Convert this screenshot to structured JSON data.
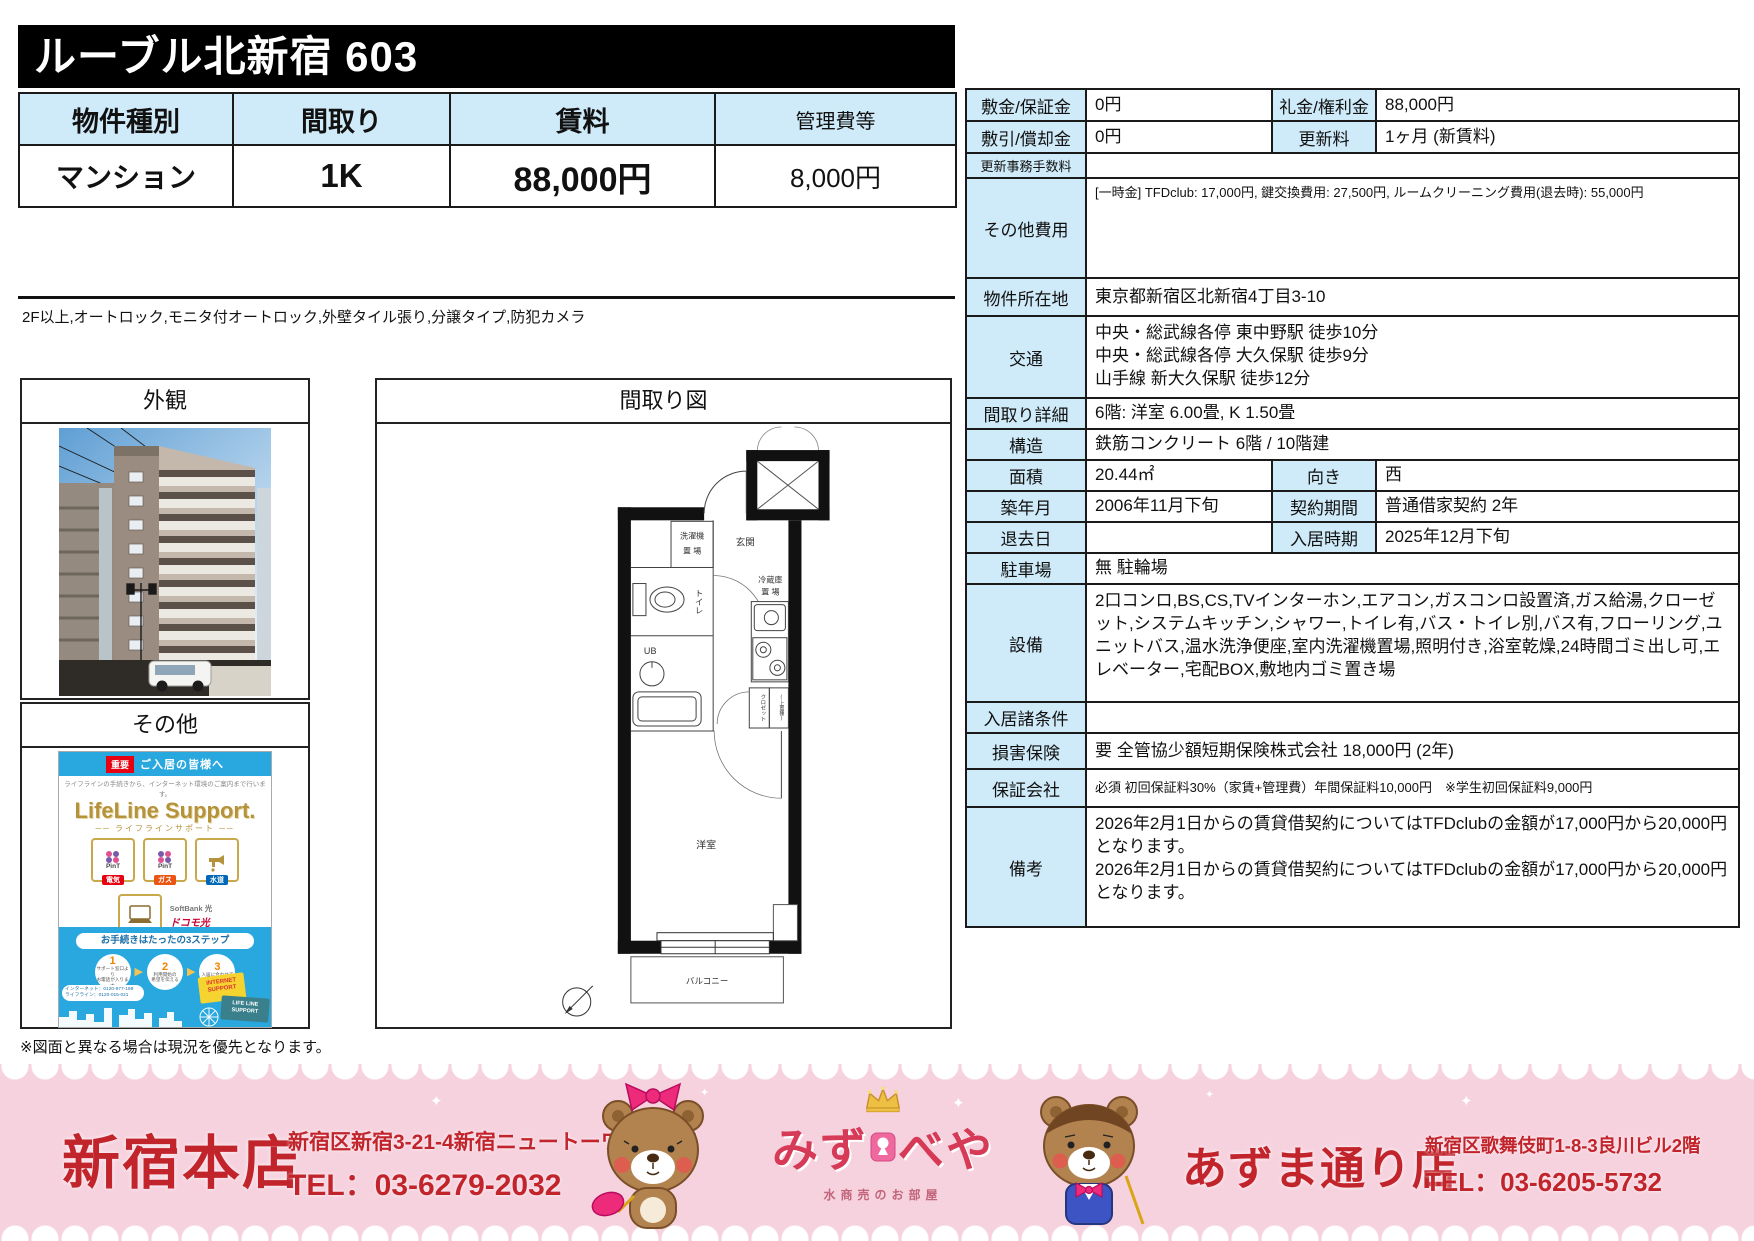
{
  "title": "ルーブル北新宿 603",
  "summary": {
    "headers": [
      "物件種別",
      "間取り",
      "賃料",
      "管理費等"
    ],
    "values": [
      "マンション",
      "1K",
      "88,000円",
      "8,000円"
    ]
  },
  "features": "2F以上,オートロック,モニタ付オートロック,外壁タイル張り,分譲タイプ,防犯カメラ",
  "photo": {
    "title": "外観"
  },
  "other": {
    "title": "その他"
  },
  "floorplan": {
    "title": "間取り図",
    "labels": {
      "washer1": "洗濯機",
      "washer2": "置 場",
      "entrance": "玄関",
      "toilet": "トイレ",
      "ub": "UB",
      "fridge1": "冷蔵庫",
      "fridge2": "置 場",
      "closet": "クロゼット",
      "shelf": "(上置棚)",
      "room": "洋室",
      "balcony": "バルコニー"
    }
  },
  "note": "※図面と異なる場合は現況を優先となります。",
  "details": {
    "rows": [
      {
        "t": "d",
        "h": 32,
        "l1": "敷金/保証金",
        "v1": "0円",
        "l2": "礼金/権利金",
        "v2": "88,000円"
      },
      {
        "t": "d",
        "h": 32,
        "l1": "敷引/償却金",
        "v1": "0円",
        "l2": "更新料",
        "v2": "1ヶ月 (新賃料)"
      },
      {
        "t": "s",
        "h": 20,
        "ls": 1,
        "l": "更新事務手数料",
        "v": ""
      },
      {
        "t": "s",
        "h": 100,
        "vs": 1,
        "top": 1,
        "l": "その他費用",
        "v": "[一時金] TFDclub: 17,000円, 鍵交換費用: 27,500円, ルームクリーニング費用(退去時): 55,000円"
      },
      {
        "t": "s",
        "h": 38,
        "l": "物件所在地",
        "v": "東京都新宿区北新宿4丁目3-10"
      },
      {
        "t": "s",
        "h": 82,
        "top": 1,
        "l": "交通",
        "v": "中央・総武線各停 東中野駅 徒歩10分\n中央・総武線各停 大久保駅 徒歩9分\n山手線 新大久保駅 徒歩12分"
      },
      {
        "t": "s",
        "h": 28,
        "l": "間取り詳細",
        "v": "6階: 洋室 6.00畳, K 1.50畳"
      },
      {
        "t": "s",
        "h": 30,
        "l": "構造",
        "v": "鉄筋コンクリート 6階 / 10階建"
      },
      {
        "t": "d",
        "h": 30,
        "l1": "面積",
        "v1": "20.44㎡",
        "l2": "向き",
        "v2": "西"
      },
      {
        "t": "d",
        "h": 30,
        "l1": "築年月",
        "v1": "2006年11月下旬",
        "l2": "契約期間",
        "v2": "普通借家契約 2年"
      },
      {
        "t": "d",
        "h": 30,
        "l1": "退去日",
        "v1": "",
        "l2": "入居時期",
        "v2": "2025年12月下旬"
      },
      {
        "t": "s",
        "h": 30,
        "l": "駐車場",
        "v": "無 駐輪場"
      },
      {
        "t": "s",
        "h": 118,
        "top": 1,
        "l": "設備",
        "v": "2口コンロ,BS,CS,TVインターホン,エアコン,ガスコンロ設置済,ガス給湯,クローゼット,システムキッチン,シャワー,トイレ有,バス・トイレ別,バス有,フローリング,ユニットバス,温水洗浄便座,室内洗濯機置場,照明付き,浴室乾燥,24時間ゴミ出し可,エレベーター,宅配BOX,敷地内ゴミ置き場"
      },
      {
        "t": "s",
        "h": 30,
        "l": "入居諸条件",
        "v": ""
      },
      {
        "t": "s",
        "h": 36,
        "l": "損害保険",
        "v": "要 全管協少額短期保険株式会社 18,000円 (2年)"
      },
      {
        "t": "s",
        "h": 38,
        "vs": 1,
        "l": "保証会社",
        "v": "必須 初回保証料30%（家賃+管理費）年間保証料10,000円　※学生初回保証料9,000円"
      },
      {
        "t": "s",
        "h": 120,
        "top": 1,
        "l": "備考",
        "v": "2026年2月1日からの賃貸借契約についてはTFDclubの金額が17,000円から20,000円となります。\n2026年2月1日からの賃貸借契約についてはTFDclubの金額が17,000円から20,000円となります。"
      }
    ]
  },
  "flyer": {
    "important": "重要",
    "audience": "ご入居の皆様へ",
    "tagline": "ライフラインの手続きから、インターネット環境のご案内まで行います。",
    "brand": "LifeLine Support.",
    "brand_kana": "── ライフラインサポート ──",
    "pint": "PinT",
    "utility_badges": [
      "電気",
      "ガス",
      "水道"
    ],
    "softbank": "SoftBank 光",
    "docomo": "ドコモ光",
    "internet_badge": "各種インターネット",
    "move_note": "お引越時の負担を軽減致します！",
    "steps_title": "お手続きはたったの3ステップ",
    "steps": [
      {
        "num": "1",
        "label": "サポート窓口より\nお電話が入ります"
      },
      {
        "num": "2",
        "label": "利用開始の\n希望を伝える"
      },
      {
        "num": "3",
        "label": "入居に合わせて\n利用開始"
      }
    ],
    "phone_lines": "インターネット：0120-977-198\nライフライン：0120-015-021",
    "cards": [
      "INTERNET\nSUPPORT",
      "LIFE LINE\nSUPPORT"
    ]
  },
  "footer": {
    "shinjuku": {
      "name": "新宿本店",
      "address": "新宿区新宿3-21-4新宿ニュートーワビル1階",
      "tel": "TEL：03-6279-2032"
    },
    "azuma": {
      "name": "あずま通り店",
      "address": "新宿区歌舞伎町1-8-3良川ビル2階",
      "tel": "TEL：03-6205-5732"
    },
    "logo": {
      "main_left": "みず",
      "main_right": "べや",
      "sub": "水商売のお部屋"
    }
  },
  "colors": {
    "header_blue": "#cfeaf8",
    "banner_pink": "#f6d2de",
    "accent_red": "#c2242c",
    "flyer_blue": "#29a8e0"
  }
}
